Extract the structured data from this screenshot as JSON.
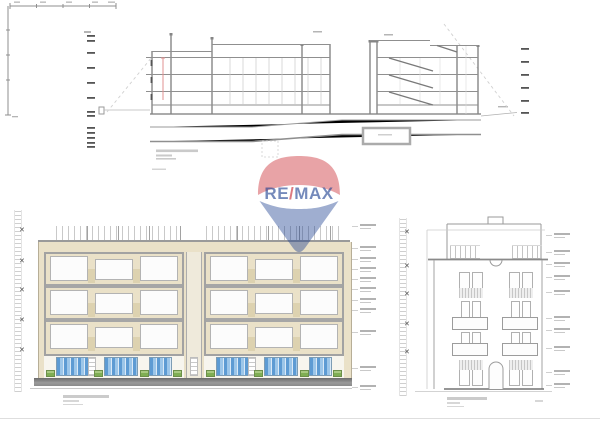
{
  "watermark": {
    "brand": "RE/MAX",
    "re": "RE",
    "slash": "/",
    "max": "MAX"
  },
  "symbols": {
    "x_marker": "✕"
  },
  "palette": {
    "accent_red": "#c8232c",
    "accent_blue": "#1a3d8f",
    "facade_beige": "#eae1c8",
    "spandrel_beige": "#ddd2b0",
    "slab_gray": "#a6a6a6",
    "line_gray": "#8f8f8f",
    "glass_blue": "#5d9bd3",
    "glass_blue_light": "#9cc6e9",
    "planter_green": "#7fae54",
    "planter_green_light": "#a8c981",
    "sidewalk_gray": "#8b8b8b",
    "section_red_line": "#e09090"
  }
}
